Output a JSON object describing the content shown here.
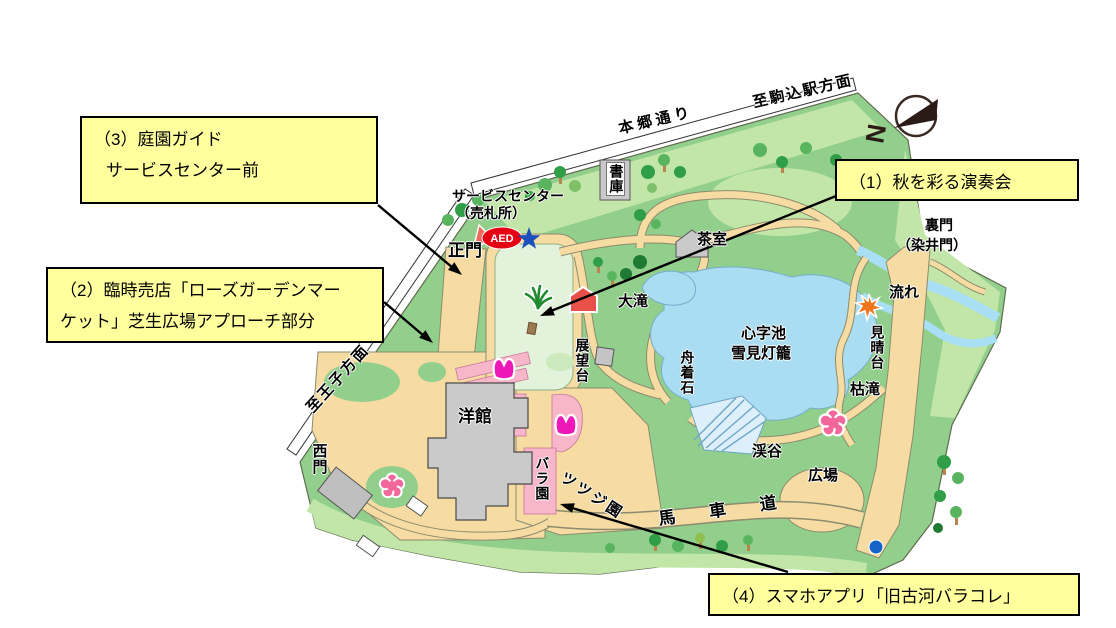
{
  "callouts": {
    "c1": {
      "label": "（1）秋を彩る演奏会"
    },
    "c2": {
      "line1": "（2）臨時売店「ローズガーデンマー",
      "line2": "ケット」芝生広場アプローチ部分"
    },
    "c3": {
      "line1": "（3）庭園ガイド",
      "line2": "サービスセンター前"
    },
    "c4": {
      "label": "（4）スマホアプリ「旧古河バラコレ」"
    }
  },
  "map": {
    "roads": {
      "hongo": "本郷通り",
      "to_komagome": "至駒込駅方面",
      "to_oji": "至王子方面"
    },
    "gates": {
      "main": "正門",
      "west": "西門",
      "rear_line1": "裏門",
      "rear_line2": "（染井門）"
    },
    "facilities": {
      "service_center_line1": "サービスセンター",
      "service_center_line2": "（売札所）",
      "shoko": "書庫",
      "chashitsu": "茶室",
      "yokan": "洋館",
      "tenbodai": "展望台"
    },
    "features": {
      "otaki": "大滝",
      "shinjiike": "心字池",
      "yukimidoro": "雪見灯籠",
      "funatsukiishi": "舟着石",
      "baraen": "バラ園",
      "tsutsujien": "ツツジ園",
      "bashamichi": "馬車道",
      "keikoku": "渓谷",
      "hiroba": "広場",
      "nagare": "流れ",
      "miharashidai": "見晴台",
      "karetaki": "枯滝"
    },
    "badges": {
      "aed": "AED"
    },
    "compass": {
      "letter": "N"
    }
  },
  "colors": {
    "callout_bg": "#ffff9e",
    "map_green": "#92cf8c",
    "light_green": "#c2e6a8",
    "lawn_green": "#e3f2da",
    "path_tan": "#f6dba2",
    "water_blue": "#aadcf2",
    "rose_pink": "#f8b6cb",
    "building_gray": "#c9c9c9",
    "aed_red": "#e60013",
    "star_blue": "#1c50be",
    "tulip_magenta": "#ee18b8",
    "sakura_pink": "#f4679a",
    "maple_orange": "#f0761e",
    "dot_blue": "#1663c7"
  }
}
